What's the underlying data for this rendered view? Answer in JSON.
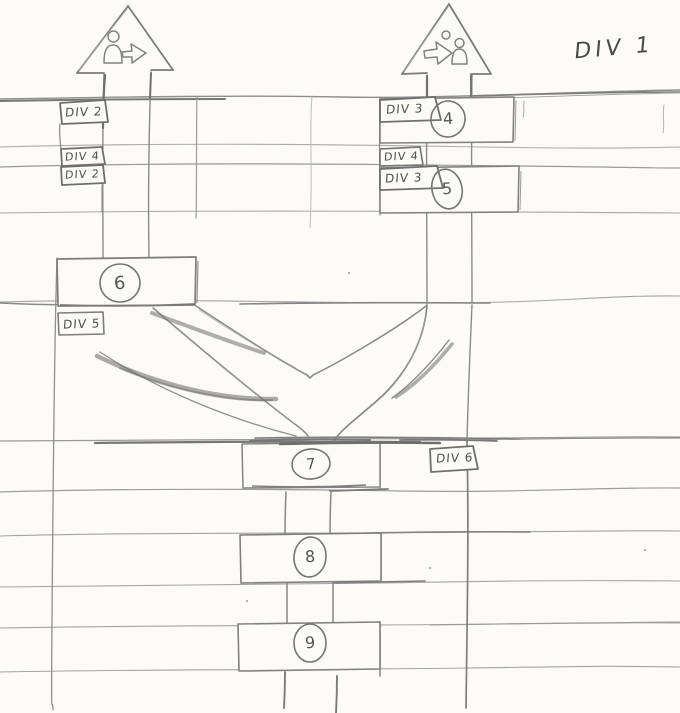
{
  "diagram": {
    "corner_label": "DIV 1",
    "icons": {
      "left_arrow_icon": "person-exit-right-icon",
      "right_arrow_icon": "arrow-enter-person-icon"
    },
    "left_tags": [
      "DIV 2",
      "DIV 4",
      "DIV 2"
    ],
    "right_tags": [
      "DIV 3",
      "DIV 4",
      "DIV 3"
    ],
    "div5_tag": "DIV 5",
    "div6_tag": "DIV 6",
    "nodes": {
      "n4": "4",
      "n5": "5",
      "n6": "6",
      "n7": "7",
      "n8": "8",
      "n9": "9"
    }
  }
}
